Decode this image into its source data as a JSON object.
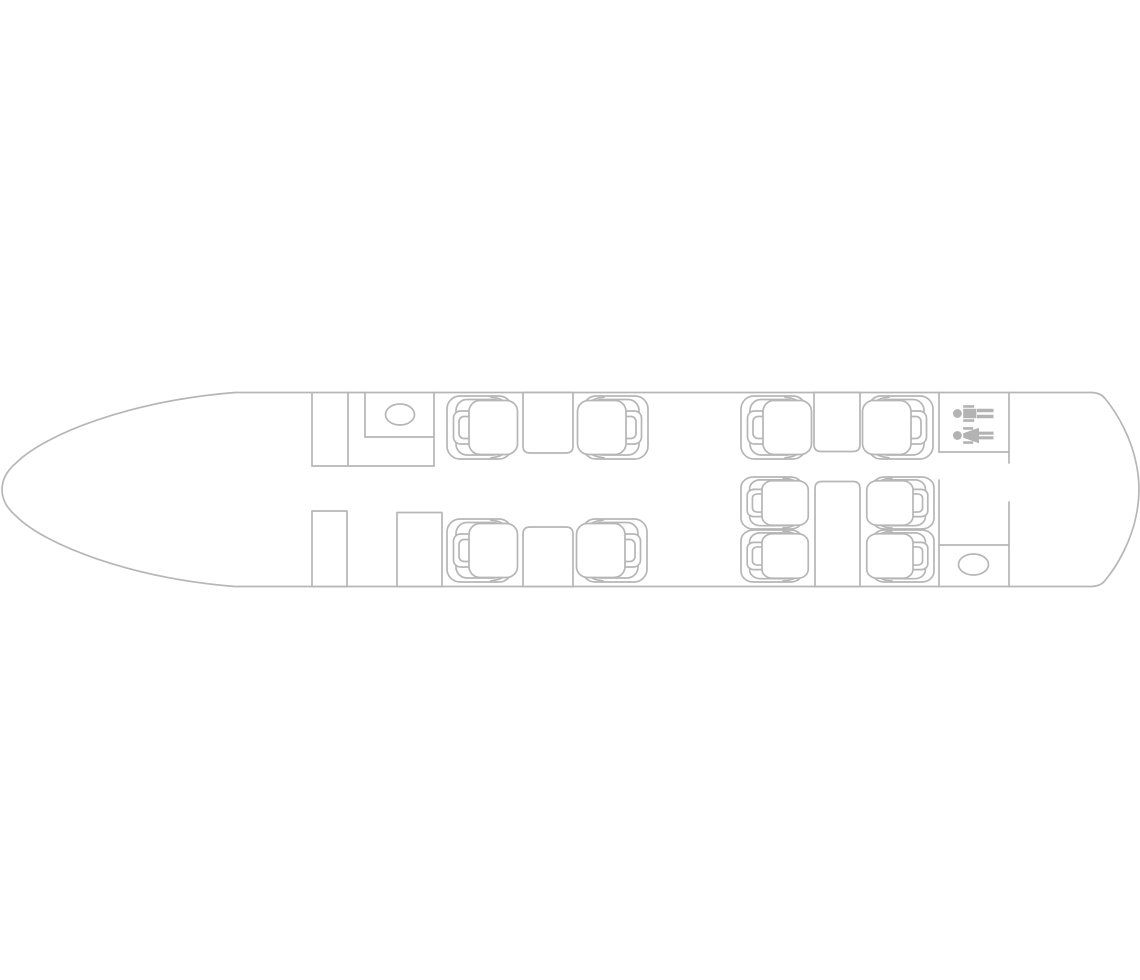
{
  "page": {
    "background_color": "#ffffff",
    "description": "aircraft cabin floor plan, top view, nose pointing left, line drawing"
  },
  "floorplan": {
    "colors": {
      "line": "#b6b6b6",
      "icon": "#b3b3b3",
      "fill": "#ffffff"
    },
    "summary": {
      "seat_count": 10,
      "table_count": 4,
      "closet_count": 2,
      "sink_count": 2,
      "lavatory_sign": "man-and-woman"
    },
    "outline": {
      "name": "fuselage-outline",
      "path": "M 235 392.5 L 1092 392.5 Q 1101 393 1105 398.5 C 1118 414 1131.5 439 1136.3 464 Q 1139 477 1139 489.5 Q 1139 502 1136.3 515 C 1131.5 540 1118 565 1105 580.5 Q 1101 586 1092 586.5 L 235 586.5 C 130 578 45 545 16 516 Q 2 504 2 489.5 Q 2 475 16 463 C 45 434 130 401 235 392.5 Z"
    },
    "partitions": [
      {
        "name": "cockpit-bulkhead-upper",
        "x1": 312,
        "y1": 392.5,
        "x2": 312,
        "y2": 466
      },
      {
        "name": "vestibule-wall",
        "x1": 348,
        "y1": 392.5,
        "x2": 348,
        "y2": 466
      },
      {
        "name": "galley-counter-left",
        "x1": 365,
        "y1": 392.5,
        "x2": 365,
        "y2": 437
      },
      {
        "name": "galley-counter-bottom",
        "x1": 365,
        "y1": 437,
        "x2": 434,
        "y2": 437
      },
      {
        "name": "galley-wall-right",
        "x1": 434,
        "y1": 392.5,
        "x2": 434,
        "y2": 466
      },
      {
        "name": "galley-floor-line",
        "x1": 312,
        "y1": 466,
        "x2": 434,
        "y2": 466
      },
      {
        "name": "lavatory-wall-left",
        "x1": 939,
        "y1": 392.5,
        "x2": 939,
        "y2": 452
      },
      {
        "name": "lavatory-wall-bottom",
        "x1": 939,
        "y1": 452,
        "x2": 1009,
        "y2": 452
      },
      {
        "name": "lavatory-wall-right",
        "x1": 1009,
        "y1": 392.5,
        "x2": 1009,
        "y2": 463
      },
      {
        "name": "aft-wall-left-lower",
        "x1": 939,
        "y1": 480,
        "x2": 939,
        "y2": 586.5
      },
      {
        "name": "aft-closet-top",
        "x1": 939,
        "y1": 545,
        "x2": 1009,
        "y2": 545
      },
      {
        "name": "aft-wall-right-lower",
        "x1": 1009,
        "y1": 502,
        "x2": 1009,
        "y2": 586.5
      }
    ],
    "closets": [
      {
        "name": "forward-closet-left",
        "x": 312,
        "y": 511,
        "w": 35,
        "h": 75.5
      },
      {
        "name": "forward-closet-right",
        "x": 397,
        "y": 512.5,
        "w": 45,
        "h": 74
      }
    ],
    "fixtures": [
      {
        "name": "galley-sink",
        "cx": 400,
        "cy": 414.5,
        "rx": 14.5,
        "ry": 10.5
      },
      {
        "name": "aft-lavatory-sink",
        "cx": 973.5,
        "cy": 564.5,
        "rx": 15,
        "ry": 10.5
      }
    ],
    "tables": [
      {
        "name": "table-forward-upper",
        "x": 523,
        "y": 392.5,
        "w": 50,
        "h": 60.5,
        "attach": "top"
      },
      {
        "name": "table-aft-upper",
        "x": 814,
        "y": 392.5,
        "w": 46,
        "h": 59,
        "attach": "top"
      },
      {
        "name": "table-forward-lower",
        "x": 523,
        "y": 527,
        "w": 50,
        "h": 59.5,
        "attach": "bottom"
      },
      {
        "name": "conference-table",
        "x": 815,
        "y": 481.5,
        "w": 45,
        "h": 105,
        "attach": "bottom"
      }
    ],
    "seats": [
      {
        "name": "seat-forward-upper-left",
        "x": 447,
        "y": 396,
        "w": 65,
        "h": 63,
        "facing": "right"
      },
      {
        "name": "seat-forward-upper-right",
        "x": 583,
        "y": 396,
        "w": 65,
        "h": 63,
        "facing": "left"
      },
      {
        "name": "seat-aft-upper-left",
        "x": 741,
        "y": 396,
        "w": 65,
        "h": 63,
        "facing": "right"
      },
      {
        "name": "seat-aft-upper-right",
        "x": 868,
        "y": 396,
        "w": 65,
        "h": 63,
        "facing": "left"
      },
      {
        "name": "seat-forward-lower-left",
        "x": 447,
        "y": 519,
        "w": 65,
        "h": 63,
        "facing": "right"
      },
      {
        "name": "seat-forward-lower-right",
        "x": 582,
        "y": 519,
        "w": 65,
        "h": 63,
        "facing": "left"
      },
      {
        "name": "seat-conference-left-1",
        "x": 741,
        "y": 477,
        "w": 62,
        "h": 52,
        "facing": "right"
      },
      {
        "name": "seat-conference-left-2",
        "x": 741,
        "y": 530,
        "w": 62,
        "h": 52,
        "facing": "right"
      },
      {
        "name": "seat-conference-right-1",
        "x": 872,
        "y": 477,
        "w": 62,
        "h": 52,
        "facing": "left"
      },
      {
        "name": "seat-conference-right-2",
        "x": 872,
        "y": 530,
        "w": 62,
        "h": 52,
        "facing": "left"
      }
    ],
    "lavatory_icons": [
      {
        "name": "restroom-man",
        "glyph": "man",
        "cx": 973.5,
        "cy": 413.5,
        "rotate": -90
      },
      {
        "name": "restroom-woman",
        "glyph": "woman",
        "cx": 973.5,
        "cy": 435.5,
        "rotate": -90
      }
    ],
    "icon_paths": {
      "man": "M 0 -20.5 a 4.4 4.4 0 1 0 0.01 0 Z M -4.8 -10.3 h 9.6 v 13.2 h -9.6 Z M -8.4 -10.3 h 2.7 v 11 h -2.7 Z M 5.7 -10.3 h 2.7 v 11 h -2.7 Z M -4.8 3.5 h 3.6 v 16.5 h -3.6 Z M 1.2 3.5 h 3.6 v 16.5 h -3.6 Z",
      "woman": "M 0 -20.5 a 4.4 4.4 0 1 0 0.01 0 Z M -8.4 -10.3 h 2.7 v 10 h -2.7 Z M 5.7 -10.3 h 2.7 v 10 h -2.7 Z M -2.2 -10.3 h 4.4 L 7.7 5.5 h -15.4 Z M -3.9 5.5 h 3.1 v 14.5 h -3.1 Z M 0.8 5.5 h 3.1 v 14.5 h -3.1 Z"
    }
  }
}
